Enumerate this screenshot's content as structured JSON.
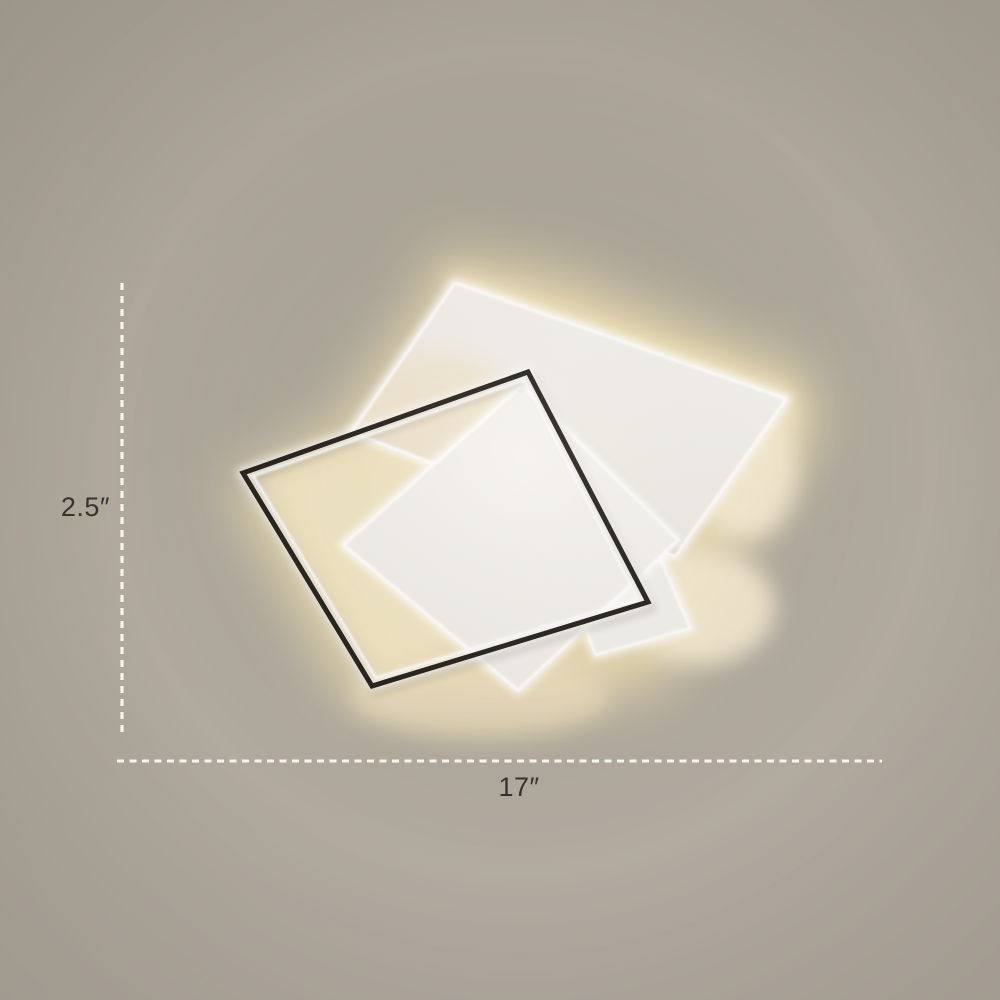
{
  "product_photo": {
    "subject": "square LED flush mount ceiling light",
    "labels": {
      "height": "2.5″",
      "width": "17″"
    }
  },
  "colors": {
    "background": "#aea79b",
    "warm_glow": "#ecddb2",
    "plate_white": "#f3f1ec",
    "panel_white": "#f5f3ee",
    "small_square_white": "#f2f0ea",
    "frame_black": "#26231e",
    "dash_line": "#f7f4ed",
    "label_text": "#35332f"
  }
}
